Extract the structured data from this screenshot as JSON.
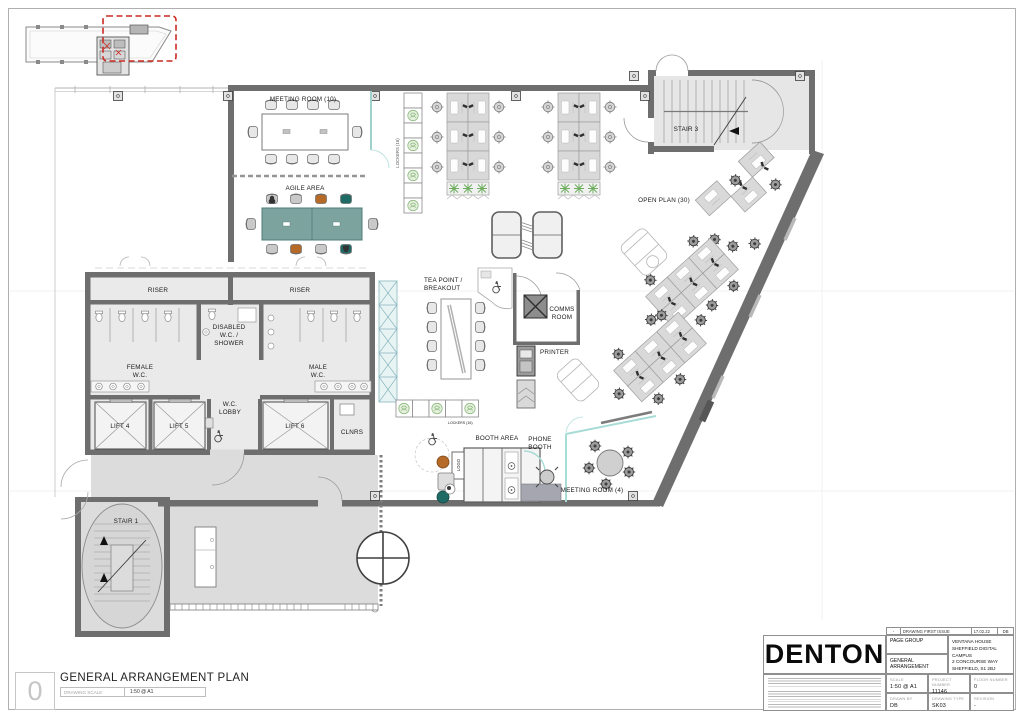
{
  "plan_labels": {
    "meeting_room_10": "MEETING ROOM (10)",
    "agile_area": "AGILE AREA",
    "lockers_16": "LOCKERS (16)",
    "open_plan_30": "OPEN PLAN (30)",
    "stair_3": "STAIR 3",
    "stair_1": "STAIR 1",
    "riser": "RISER",
    "female_l1": "FEMALE",
    "female_l2": "W.C.",
    "male_l1": "MALE",
    "male_l2": "W.C.",
    "disabled_l1": "DISABLED",
    "disabled_l2": "W.C. /",
    "disabled_l3": "SHOWER",
    "wc_lobby_l1": "W.C.",
    "wc_lobby_l2": "LOBBY",
    "lift_4": "LIFT 4",
    "lift_5": "LIFT 5",
    "lift_6": "LIFT 6",
    "clnrs": "CLNRS",
    "tea_l1": "TEA POINT /",
    "tea_l2": "BREAKOUT",
    "comms_l1": "COMMS",
    "comms_l2": "ROOM",
    "printer": "PRINTER",
    "booth_area": "BOOTH AREA",
    "phone_l1": "PHONE",
    "phone_l2": "BOOTH",
    "meeting_room_4": "MEETING ROOM (4)",
    "logo": "LOGO"
  },
  "sheet_footer": {
    "drawing_number": "0",
    "title": "GENERAL ARRANGEMENT PLAN",
    "scale_label": "DRAWING SCALE",
    "scale_value": "1:50 @ A1"
  },
  "title_block": {
    "brand": "DENTON",
    "revision_history": {
      "rev": "-",
      "description": "DRAWING FIRST ISSUE",
      "date": "17.02.22",
      "initials": "DB"
    },
    "client": "PAGE GROUP",
    "drawing_name": "GENERAL ARRANGEMENT",
    "project_address": [
      "VENTANA HOUSE",
      "SHEFFIELD DIGITAL CAMPUS",
      "2 CONCOURSE WAY",
      "SHEFFIELD, S1 2BJ"
    ],
    "fields": {
      "scale_label": "SCALE",
      "scale": "1:50 @ A1",
      "project_number_label": "PROJECT NUMBER",
      "project_number": "11146",
      "floor_number_label": "FLOOR NUMBER",
      "floor_number": "0",
      "drawn_by_label": "DRAWN BY",
      "drawn_by": "DB",
      "drawing_type_label": "DRAWING TYPE",
      "drawing_type": "SK03",
      "revision_label": "REVISION",
      "revision": "-"
    }
  },
  "colors": {
    "wall": "#6e6e6e",
    "glazing": "#9fd2cc",
    "lobby_fill": "#dcdcdc",
    "chair_orange": "#b56a28",
    "chair_teal": "#1e6b66",
    "planter_green": "#8fbb82",
    "extent_red": "#cc2a22",
    "table_teal": "#7da39f"
  }
}
